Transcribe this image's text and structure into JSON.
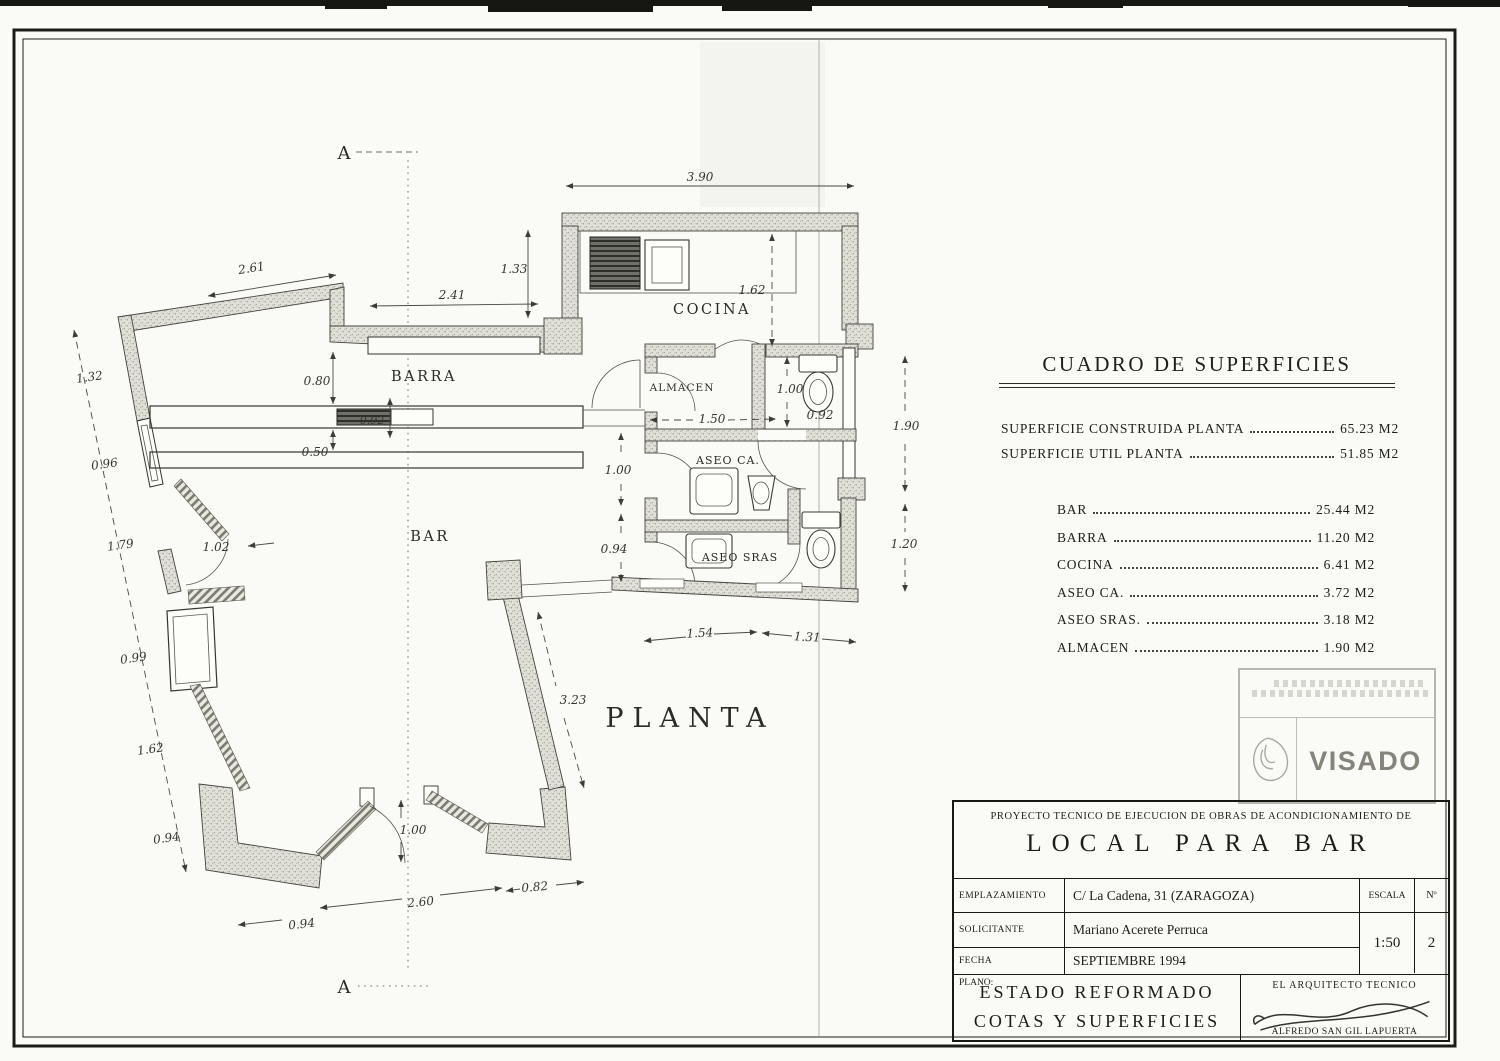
{
  "plan": {
    "section_marker": "A",
    "title": "PLANTA",
    "rooms": {
      "cocina": "COCINA",
      "barra": "BARRA",
      "bar": "BAR",
      "almacen": "ALMACEN",
      "aseo_ca": "ASEO CA.",
      "aseo_sras": "ASEO SRAS"
    },
    "dims": {
      "kitchen_width": "3.90",
      "top_recess_height": "1.33",
      "top_recess_width": "2.41",
      "top_left_wall": "2.61",
      "cocina_depth": "1.62",
      "left_chain_1": "1.32",
      "left_chain_2": "0.96",
      "left_chain_3": "1.79",
      "left_chain_4": "0.99",
      "left_chain_5": "1.62",
      "left_chain_6": "0.94",
      "barra_aisle": "0.80",
      "barra_counter": "0.50",
      "barra_unit": "0.92",
      "left_door": "1.02",
      "corridor_door": "1.00",
      "corridor_width": "0.94",
      "almacen_depth": "1.00",
      "almacen_width": "1.50",
      "wc_width": "0.92",
      "aseos_right_1": "1.90",
      "aseos_right_2": "1.20",
      "party_wall": "3.23",
      "aseos_bottom_1": "1.54",
      "aseos_bottom_2": "1.31",
      "entry_door": "1.00",
      "entry_span": "2.60",
      "entry_right": "0.82",
      "entry_left": "0.94"
    }
  },
  "surface_table": {
    "title": "CUADRO DE SUPERFICIES",
    "summary_rows": [
      {
        "label": "SUPERFICIE CONSTRUIDA PLANTA",
        "value": "65.23 M2"
      },
      {
        "label": "SUPERFICIE UTIL PLANTA",
        "value": "51.85 M2"
      }
    ],
    "rows": [
      {
        "label": "BAR",
        "value": "25.44 M2"
      },
      {
        "label": "BARRA",
        "value": "11.20 M2"
      },
      {
        "label": "COCINA",
        "value": "6.41 M2"
      },
      {
        "label": "ASEO CA.",
        "value": "3.72 M2"
      },
      {
        "label": "ASEO SRAS.",
        "value": "3.18 M2"
      },
      {
        "label": "ALMACEN",
        "value": "1.90 M2"
      }
    ]
  },
  "stamp": {
    "label": "VISADO"
  },
  "title_block": {
    "project_line": "PROYECTO TECNICO DE EJECUCION DE OBRAS DE ACONDICIONAMIENTO DE",
    "project_title": "LOCAL PARA BAR",
    "emplazamiento_label": "EMPLAZAMIENTO",
    "emplazamiento_value": "C/ La Cadena, 31 (ZARAGOZA)",
    "solicitante_label": "SOLICITANTE",
    "solicitante_value": "Mariano Acerete Perruca",
    "fecha_label": "FECHA",
    "fecha_value": "SEPTIEMBRE 1994",
    "escala_label": "ESCALA",
    "escala_value": "1:50",
    "num_label": "Nº",
    "num_value": "2",
    "plano_label": "PLANO:",
    "plano_line1": "ESTADO REFORMADO",
    "plano_line2": "COTAS Y SUPERFICIES",
    "architect_label": "EL ARQUITECTO TECNICO",
    "architect_name": "ALFREDO SAN GIL LAPUERTA"
  }
}
